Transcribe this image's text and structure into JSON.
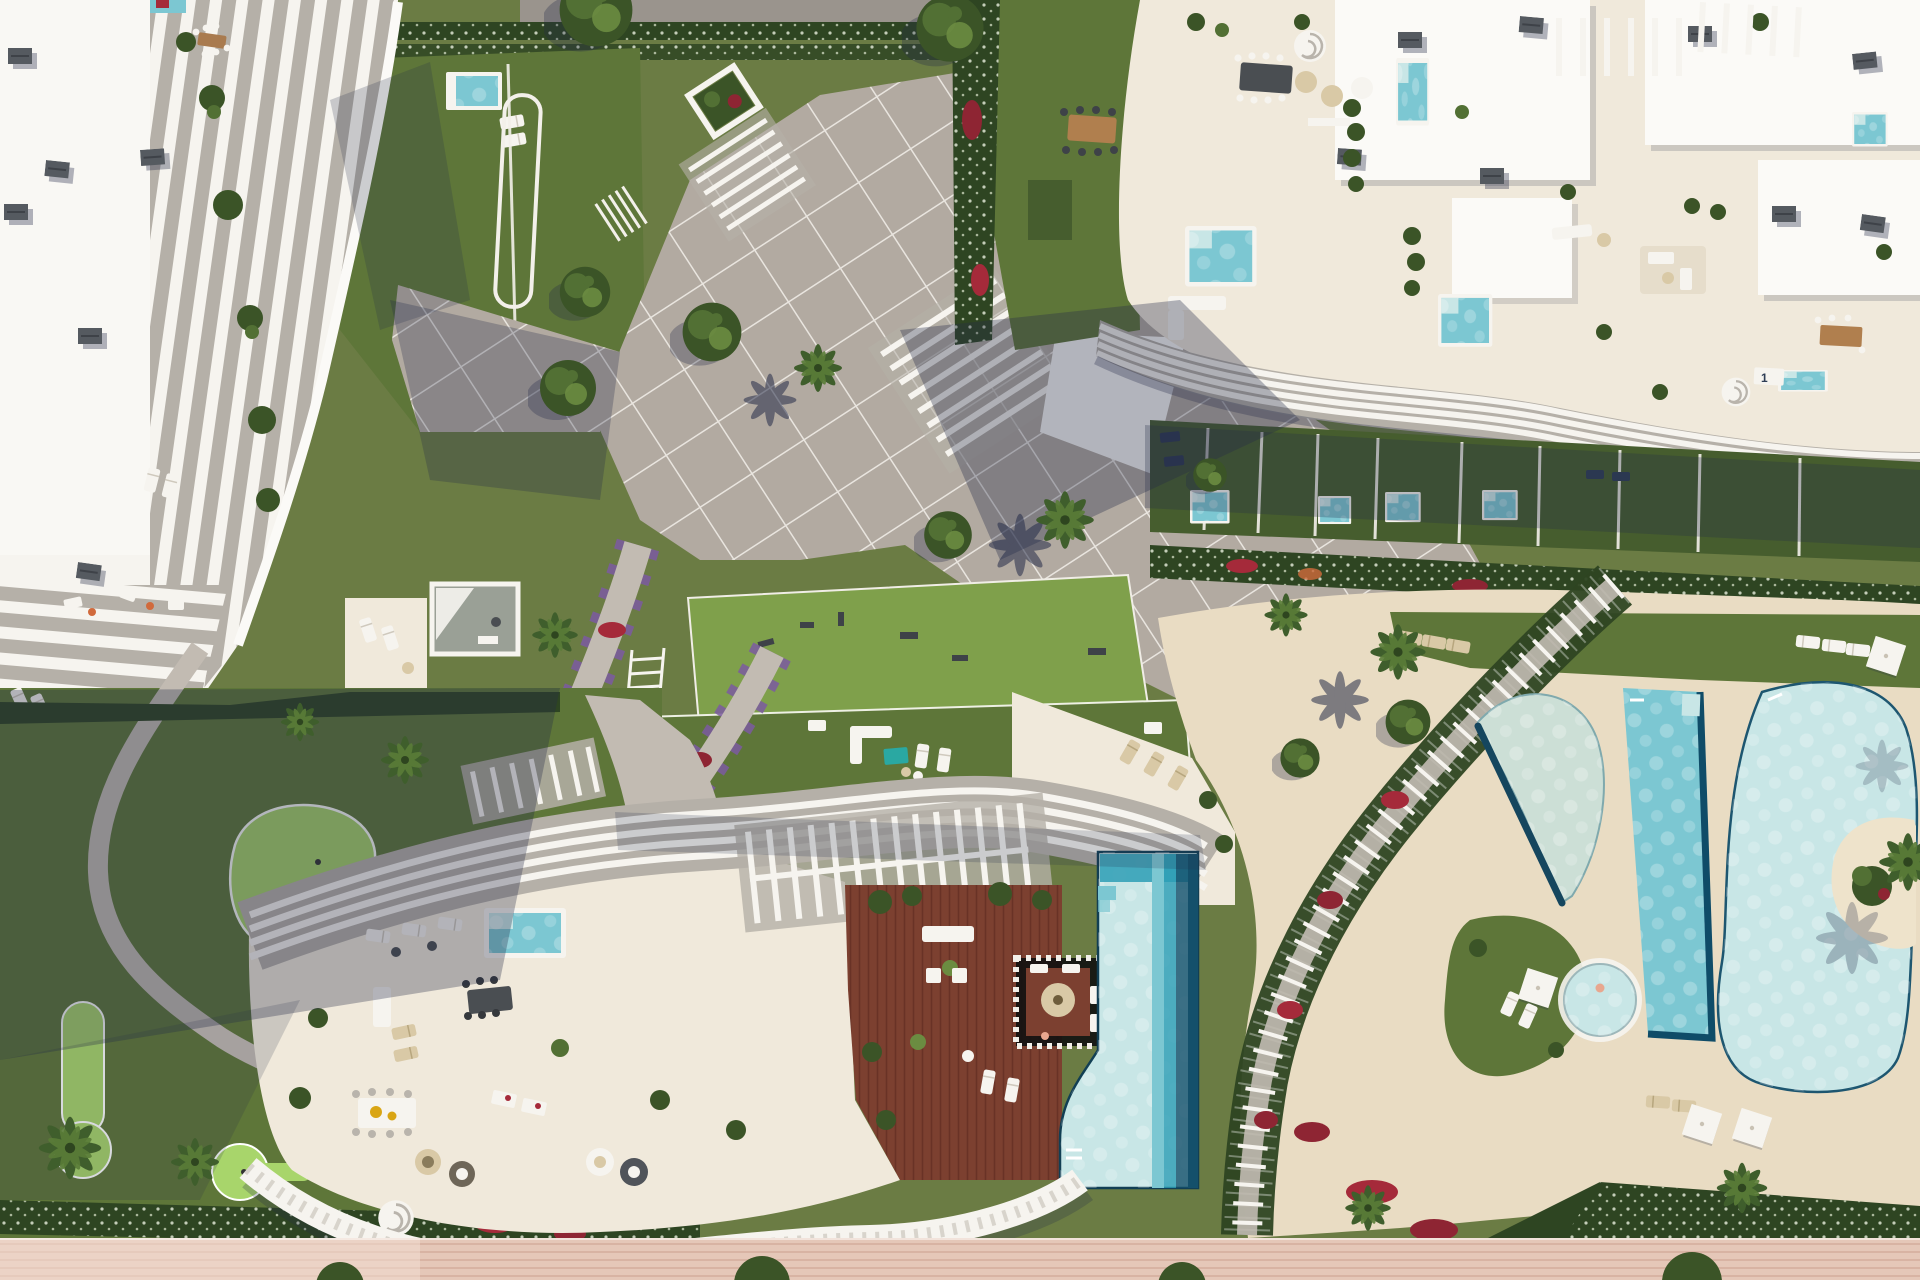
{
  "scene": {
    "type": "aerial-architectural-render",
    "description": "Top-down 3D rendering of a luxury residential resort: white sculptural apartment buildings with curved balcony fins, cream rooftop terraces with plunge pools and lounge furniture, a paved central plaza with tree planters, landscaped gardens with red and purple flower drifts, palm trees, a putting green, a central residence with wooden roof deck and stepped infinity pool, a lagoon-style communal pool zone on a sand deck with a pergola walkway, and a pink timber boardwalk along the bottom edge."
  },
  "labels": {
    "pool_sign_1": "1"
  },
  "colors": {
    "grass-base": "#6b7c44",
    "lawn-mid": "#5e7639",
    "lawn-dark": "#465d2e",
    "lawn-bright": "#7fa04b",
    "green-bright": "#a8d56b",
    "hedge-dark": "#2e4522",
    "tree-dark": "#3b5427",
    "tree-mid": "#527034",
    "tree-light": "#6b8c41",
    "palm-green": "#3f5e2c",
    "palm-light": "#5a7d38",
    "flower-red": "#a52a3a",
    "flower-crimson": "#8e2533",
    "flower-purple": "#7b5ba1",
    "path-gray": "#c2bbb2",
    "plaza-gray": "#b2aaa1",
    "road-gray": "#9a948d",
    "line-white": "#f3f0ea",
    "white": "#f6f4ef",
    "white-bright": "#fbfaf7",
    "cream": "#f0e9db",
    "sand": "#e9dcc3",
    "sand-light": "#eee3cb",
    "fin-gray": "#b5b0a8",
    "ac-gray": "#555a60",
    "shadow": "#252c49",
    "wood": "#7c4030",
    "wood-dark": "#693226",
    "board-pink": "#e5c7b8",
    "board-line": "#d5ae9e",
    "pool-pale": "#c8e6e6",
    "pool-mid": "#7cc7d2",
    "pool-deep": "#2d9db5",
    "pool-dark": "#14506b",
    "pool-sand": "#ccdfd6",
    "teal": "#2aa8a2",
    "tan": "#d9c9a6",
    "navy": "#2e3d55",
    "pink-patio": "#e8a78f",
    "orange": "#d16a3c"
  },
  "regions": [
    {
      "name": "top-left-residence",
      "description": "White building with cascading curved balcony fins and roof terraces"
    },
    {
      "name": "north-road-hedge",
      "description": "Access road and flowering hedge rows at the top edge"
    },
    {
      "name": "central-plaza",
      "description": "Gridded paved plaza with tree planters and pergola beams"
    },
    {
      "name": "top-right-residence",
      "description": "Large cream building with rooftop terraces, plunge pools and wavy balconies"
    },
    {
      "name": "private-garden-terraces",
      "description": "Ground-floor lawns with private plunge pools"
    },
    {
      "name": "central-boulevard",
      "description": "Wide diagonal paved promenade"
    },
    {
      "name": "outdoor-gym-lawn",
      "description": "Lawn with exercise equipment"
    },
    {
      "name": "podium-garden",
      "description": "Roof garden lawn with lounge furniture"
    },
    {
      "name": "flower-lined-paths",
      "description": "Gravel paths bordered by purple and red flowers"
    },
    {
      "name": "leisure-garden-putting-green",
      "description": "Putting greens, pink patio circle and palm garden"
    },
    {
      "name": "center-residence",
      "description": "Sculptural building with pergolas, terraces and spiral stair"
    },
    {
      "name": "rooftop-deck-pool",
      "description": "Wooden roof deck with striped lounge pit and stepped infinity pool"
    },
    {
      "name": "lagoon-pool-area",
      "description": "Sand deck with half-moon pool, lap pool, kids pool and lagoon with island"
    },
    {
      "name": "beach-boardwalk",
      "description": "Pink timber boardwalk along the bottom"
    }
  ]
}
